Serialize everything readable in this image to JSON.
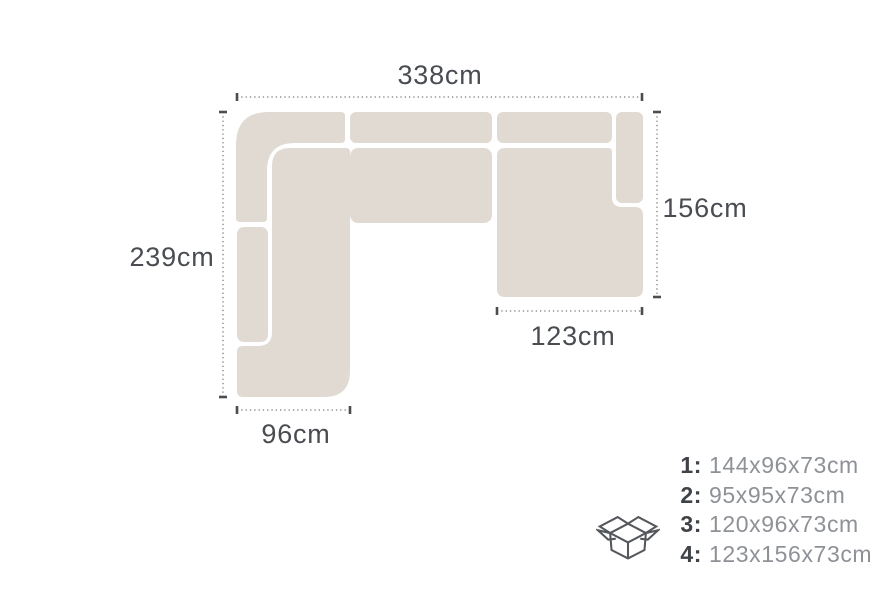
{
  "diagram": {
    "type": "sofa-dimension-plan",
    "dimensions": {
      "total_width": "338cm",
      "left_side_depth": "239cm",
      "right_side_depth": "156cm",
      "right_chaise_width": "123cm",
      "left_chaise_width": "96cm"
    },
    "colors": {
      "sofa_fill": "#e0dad3",
      "dimension_line": "#8f8f8f",
      "dimension_tick": "#4a4d52",
      "dimension_text": "#494c51"
    }
  },
  "legend": {
    "icon": "open-box-icon",
    "icon_color": "#54575c",
    "items": [
      {
        "num": "1:",
        "size": "144x96x73cm"
      },
      {
        "num": "2:",
        "size": "95x95x73cm"
      },
      {
        "num": "3:",
        "size": "120x96x73cm"
      },
      {
        "num": "4:",
        "size": "123x156x73cm"
      }
    ]
  }
}
